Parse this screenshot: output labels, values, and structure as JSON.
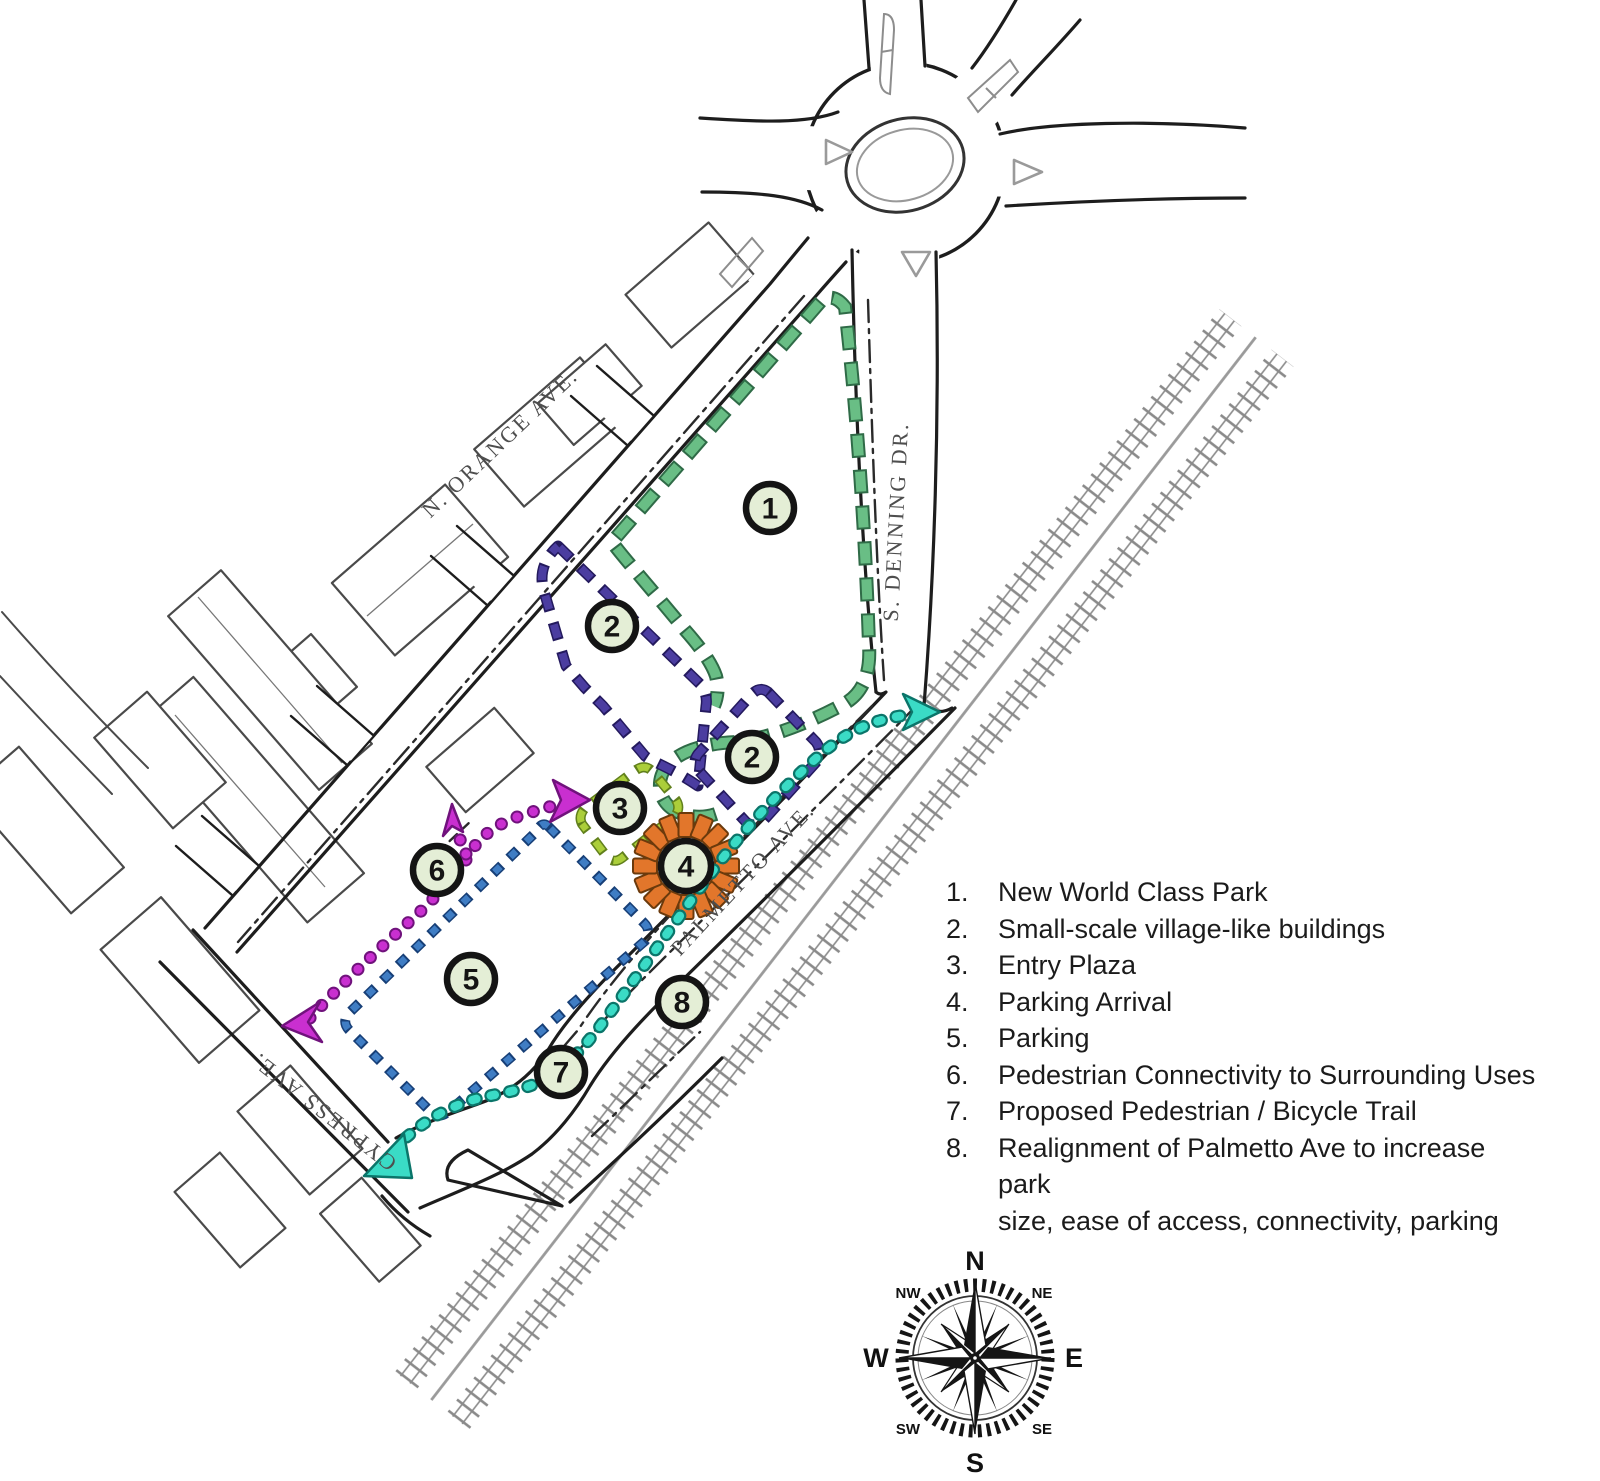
{
  "streets": {
    "orange": "N. ORANGE AVE.",
    "denning": "S. DENNING DR.",
    "palmetto": "PALMETTO AVE.",
    "cypress": "CYPRESS AVE."
  },
  "legend": {
    "items": [
      {
        "num": "1.",
        "label": "New World Class Park"
      },
      {
        "num": "2.",
        "label": "Small-scale village-like buildings"
      },
      {
        "num": "3.",
        "label": "Entry Plaza"
      },
      {
        "num": "4.",
        "label": "Parking Arrival"
      },
      {
        "num": "5.",
        "label": "Parking"
      },
      {
        "num": "6.",
        "label": "Pedestrian Connectivity to Surrounding Uses"
      },
      {
        "num": "7.",
        "label": "Proposed Pedestrian / Bicycle Trail"
      },
      {
        "num": "8.",
        "label": "Realignment of Palmetto Ave to increase park\nsize, ease of access, connectivity, parking"
      }
    ]
  },
  "badges": {
    "b1": "1",
    "b2a": "2",
    "b2b": "2",
    "b3": "3",
    "b4": "4",
    "b5": "5",
    "b6": "6",
    "b7": "7",
    "b8": "8"
  },
  "compass": {
    "n": "N",
    "ne": "NE",
    "e": "E",
    "se": "SE",
    "s": "S",
    "sw": "SW",
    "w": "W",
    "nw": "NW"
  },
  "colors": {
    "park_green": "#69be85",
    "park_green_edge": "#2f6b47",
    "village_indigo": "#4b3da0",
    "village_indigo_edge": "#241a5e",
    "plaza_lime": "#abce3a",
    "plaza_lime_edge": "#61801c",
    "parking_arrival_orange": "#e2762b",
    "parking_arrival_orange_edge": "#6b3a0c",
    "parking_blue": "#3f7dc4",
    "parking_blue_edge": "#173f77",
    "pedestrian_magenta": "#c92fd0",
    "pedestrian_magenta_edge": "#70127c",
    "trail_teal": "#3adbc6",
    "trail_teal_edge": "#0b756a",
    "badge_fill": "#e4eed6"
  }
}
